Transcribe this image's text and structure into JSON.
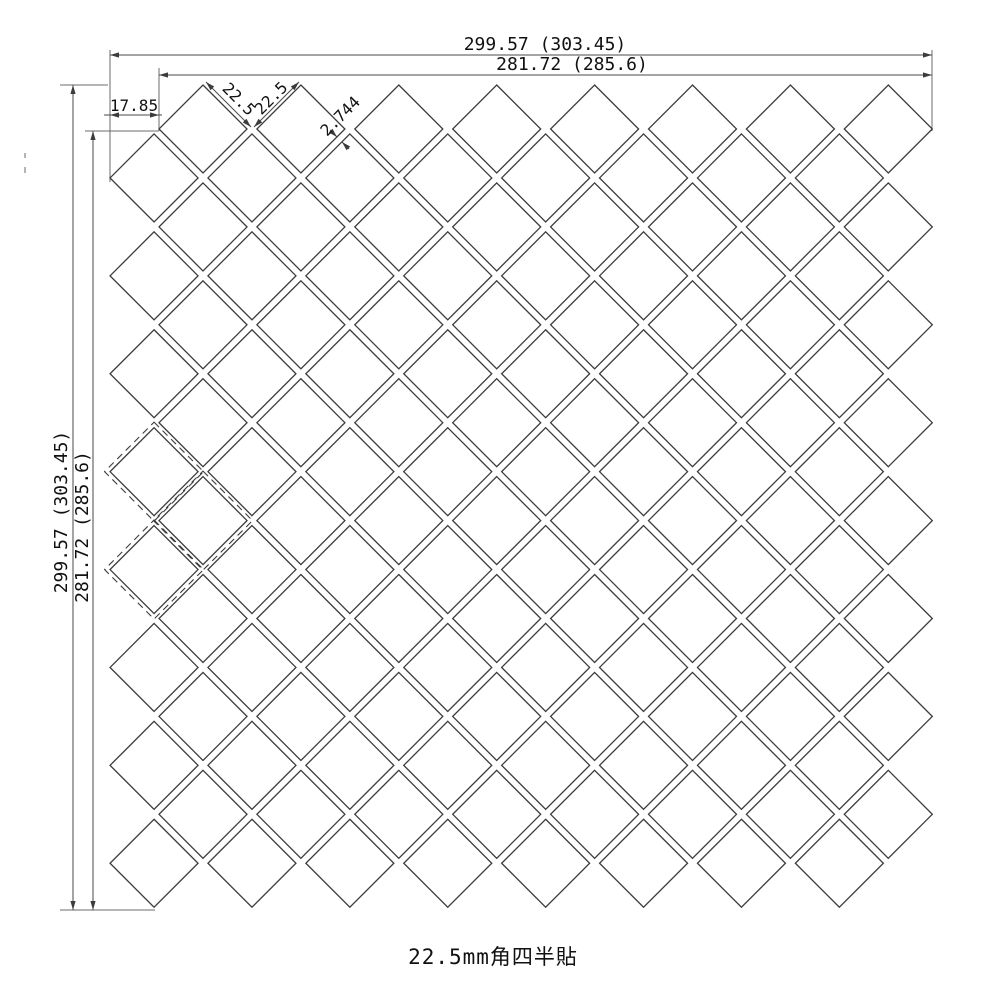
{
  "caption": "22.5mm角四半貼",
  "dimensions": {
    "top_outer": "299.57 (303.45)",
    "top_inner": "281.72 (285.6)",
    "left_outer": "299.57 (303.45)",
    "left_inner": "281.72 (285.6)",
    "edge_offset": "17.85",
    "tile_edge_1": "22.5",
    "tile_edge_2": "22.5",
    "joint_width": "2.744"
  },
  "pattern": {
    "tile_size_mm": "22.5",
    "main_grid_cols": 8,
    "main_grid_rows": 8,
    "offset_grid_cols": 8,
    "offset_grid_rows": 8,
    "dashed_tile_count": 3
  },
  "colors": {
    "tile_line": "#3c3c3c",
    "dimension_line": "#6b6b6b",
    "text": "#111111",
    "background": "#ffffff"
  }
}
